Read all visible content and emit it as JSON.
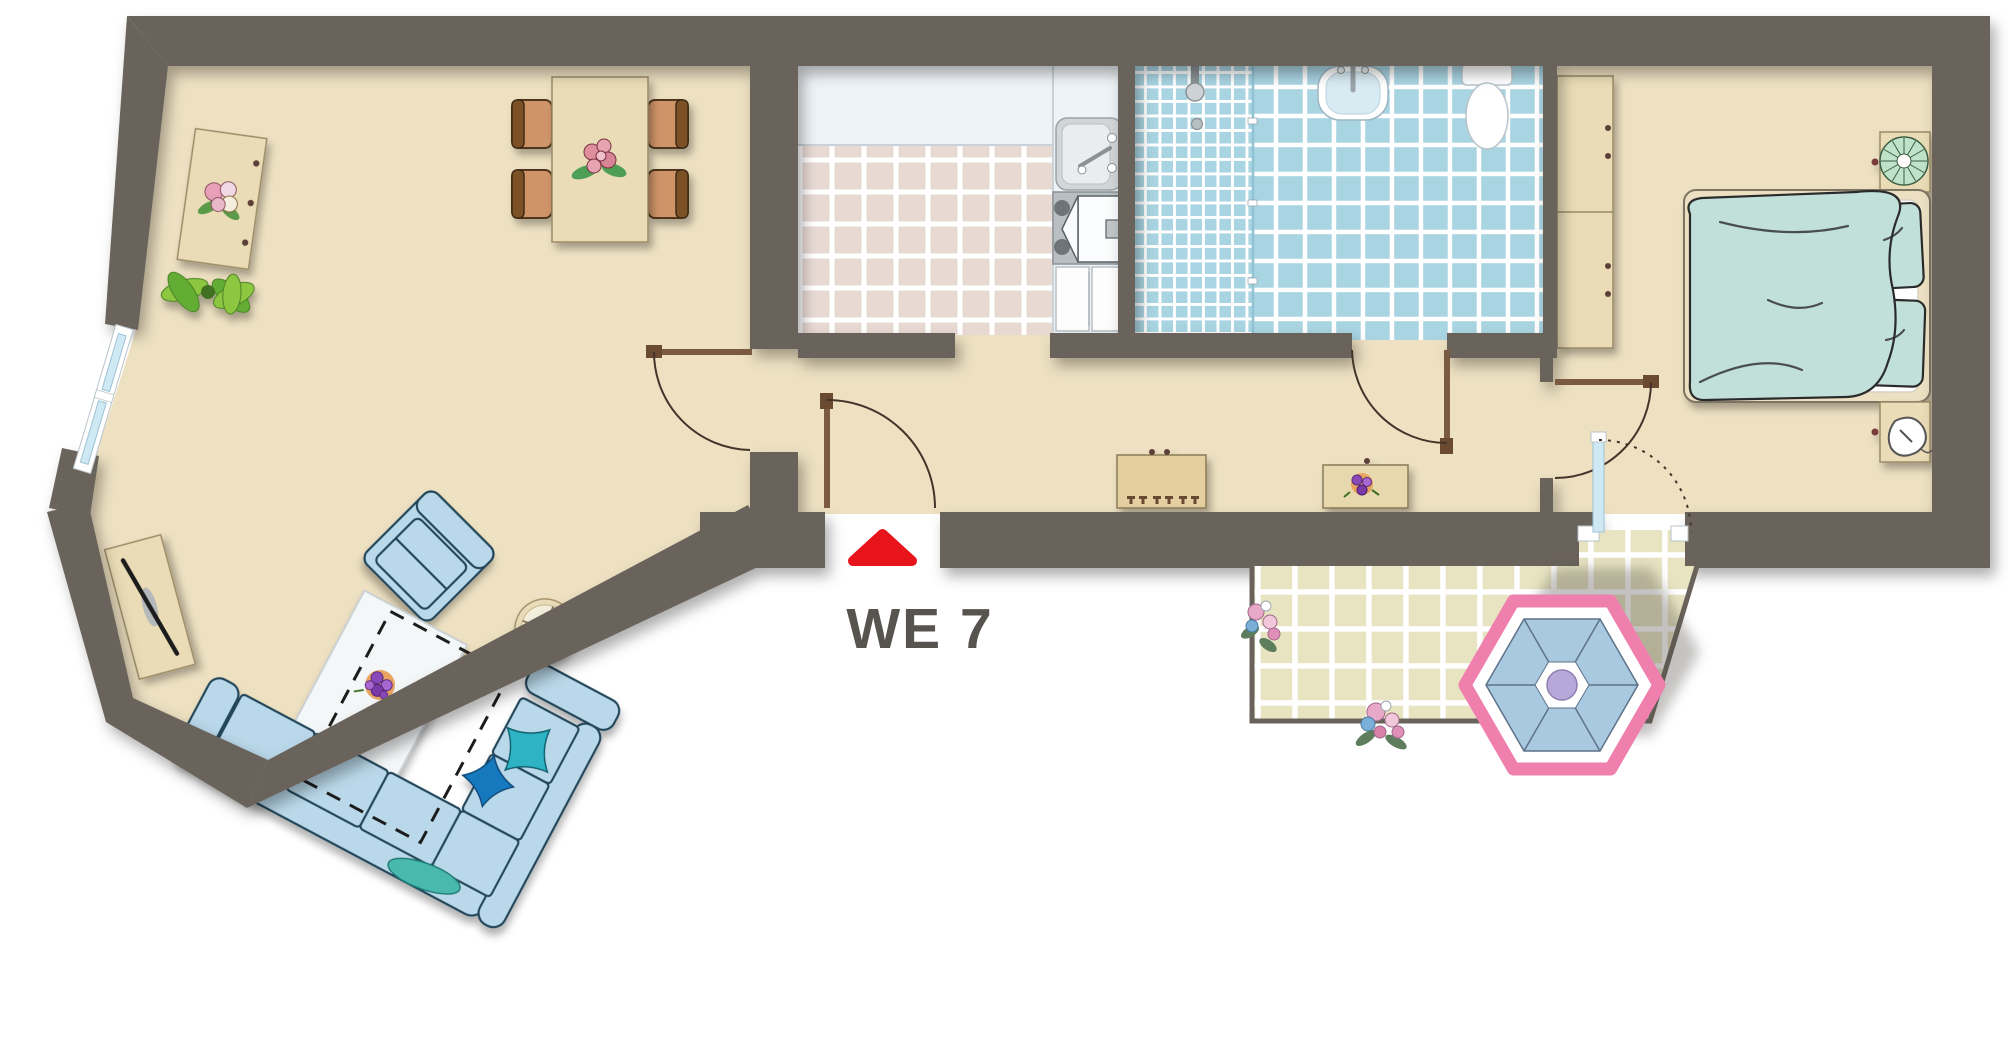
{
  "unit": {
    "label": "WE 7"
  },
  "entrance": {
    "marker": "red-entrance-triangle-icon"
  },
  "colors": {
    "wall": "#6a635c",
    "floor": "#eee1c2",
    "furn": "#e9dcb6",
    "wood": "#57432a",
    "chair": "#cf9468",
    "chairback": "#7d5126",
    "sofa": "#b9d8e9",
    "sofaline": "#24465a",
    "pteal": "#2eb3c5",
    "pblue": "#1779bd",
    "ktile": "#e8d9d3",
    "counter": "#eef3f7",
    "btile": "#a9d4e2",
    "ttile": "#e8e4c2",
    "grout": "#ffffff",
    "duvet": "#c2e0da",
    "door": "#7a5a40",
    "arc": "#44342a",
    "red": "#e8141b",
    "label": "#57534e",
    "glass": "#cfe9f4",
    "metal": "#c3c9cc",
    "knob": "#5d4037",
    "planta": "#8dc63f",
    "plantb": "#63ad34",
    "parasolpink": "#ef7fad",
    "parasolblue": "#a9c9e1",
    "lavender": "#b8a8da"
  },
  "rooms": [
    {
      "name": "living-room",
      "furniture": [
        "sideboard-with-flowers",
        "potted-plant",
        "dining-table-with-flowers",
        "dining-chairs-x4",
        "tv-lowboard",
        "armchair",
        "coffee-table-with-flowers",
        "corner-sofa-with-pillows",
        "round-side-table",
        "rug-outline"
      ]
    },
    {
      "name": "kitchen",
      "furniture": [
        "countertop",
        "kitchen-sink",
        "stove-with-extractor",
        "refrigerator-cabinets"
      ]
    },
    {
      "name": "bathroom",
      "furniture": [
        "shower-with-head-and-drain",
        "glass-partition",
        "washbasin",
        "toilet"
      ]
    },
    {
      "name": "hallway",
      "furniture": [
        "shoe-cabinet",
        "console-table-with-flowers"
      ]
    },
    {
      "name": "bedroom",
      "furniture": [
        "wardrobe",
        "double-bed-with-duvet-and-pillows",
        "nightstand-with-plant",
        "nightstand-with-lamp"
      ]
    },
    {
      "name": "terrace",
      "furniture": [
        "hexagonal-parasol",
        "flower-bush-left",
        "flower-bush-bottom"
      ]
    }
  ]
}
